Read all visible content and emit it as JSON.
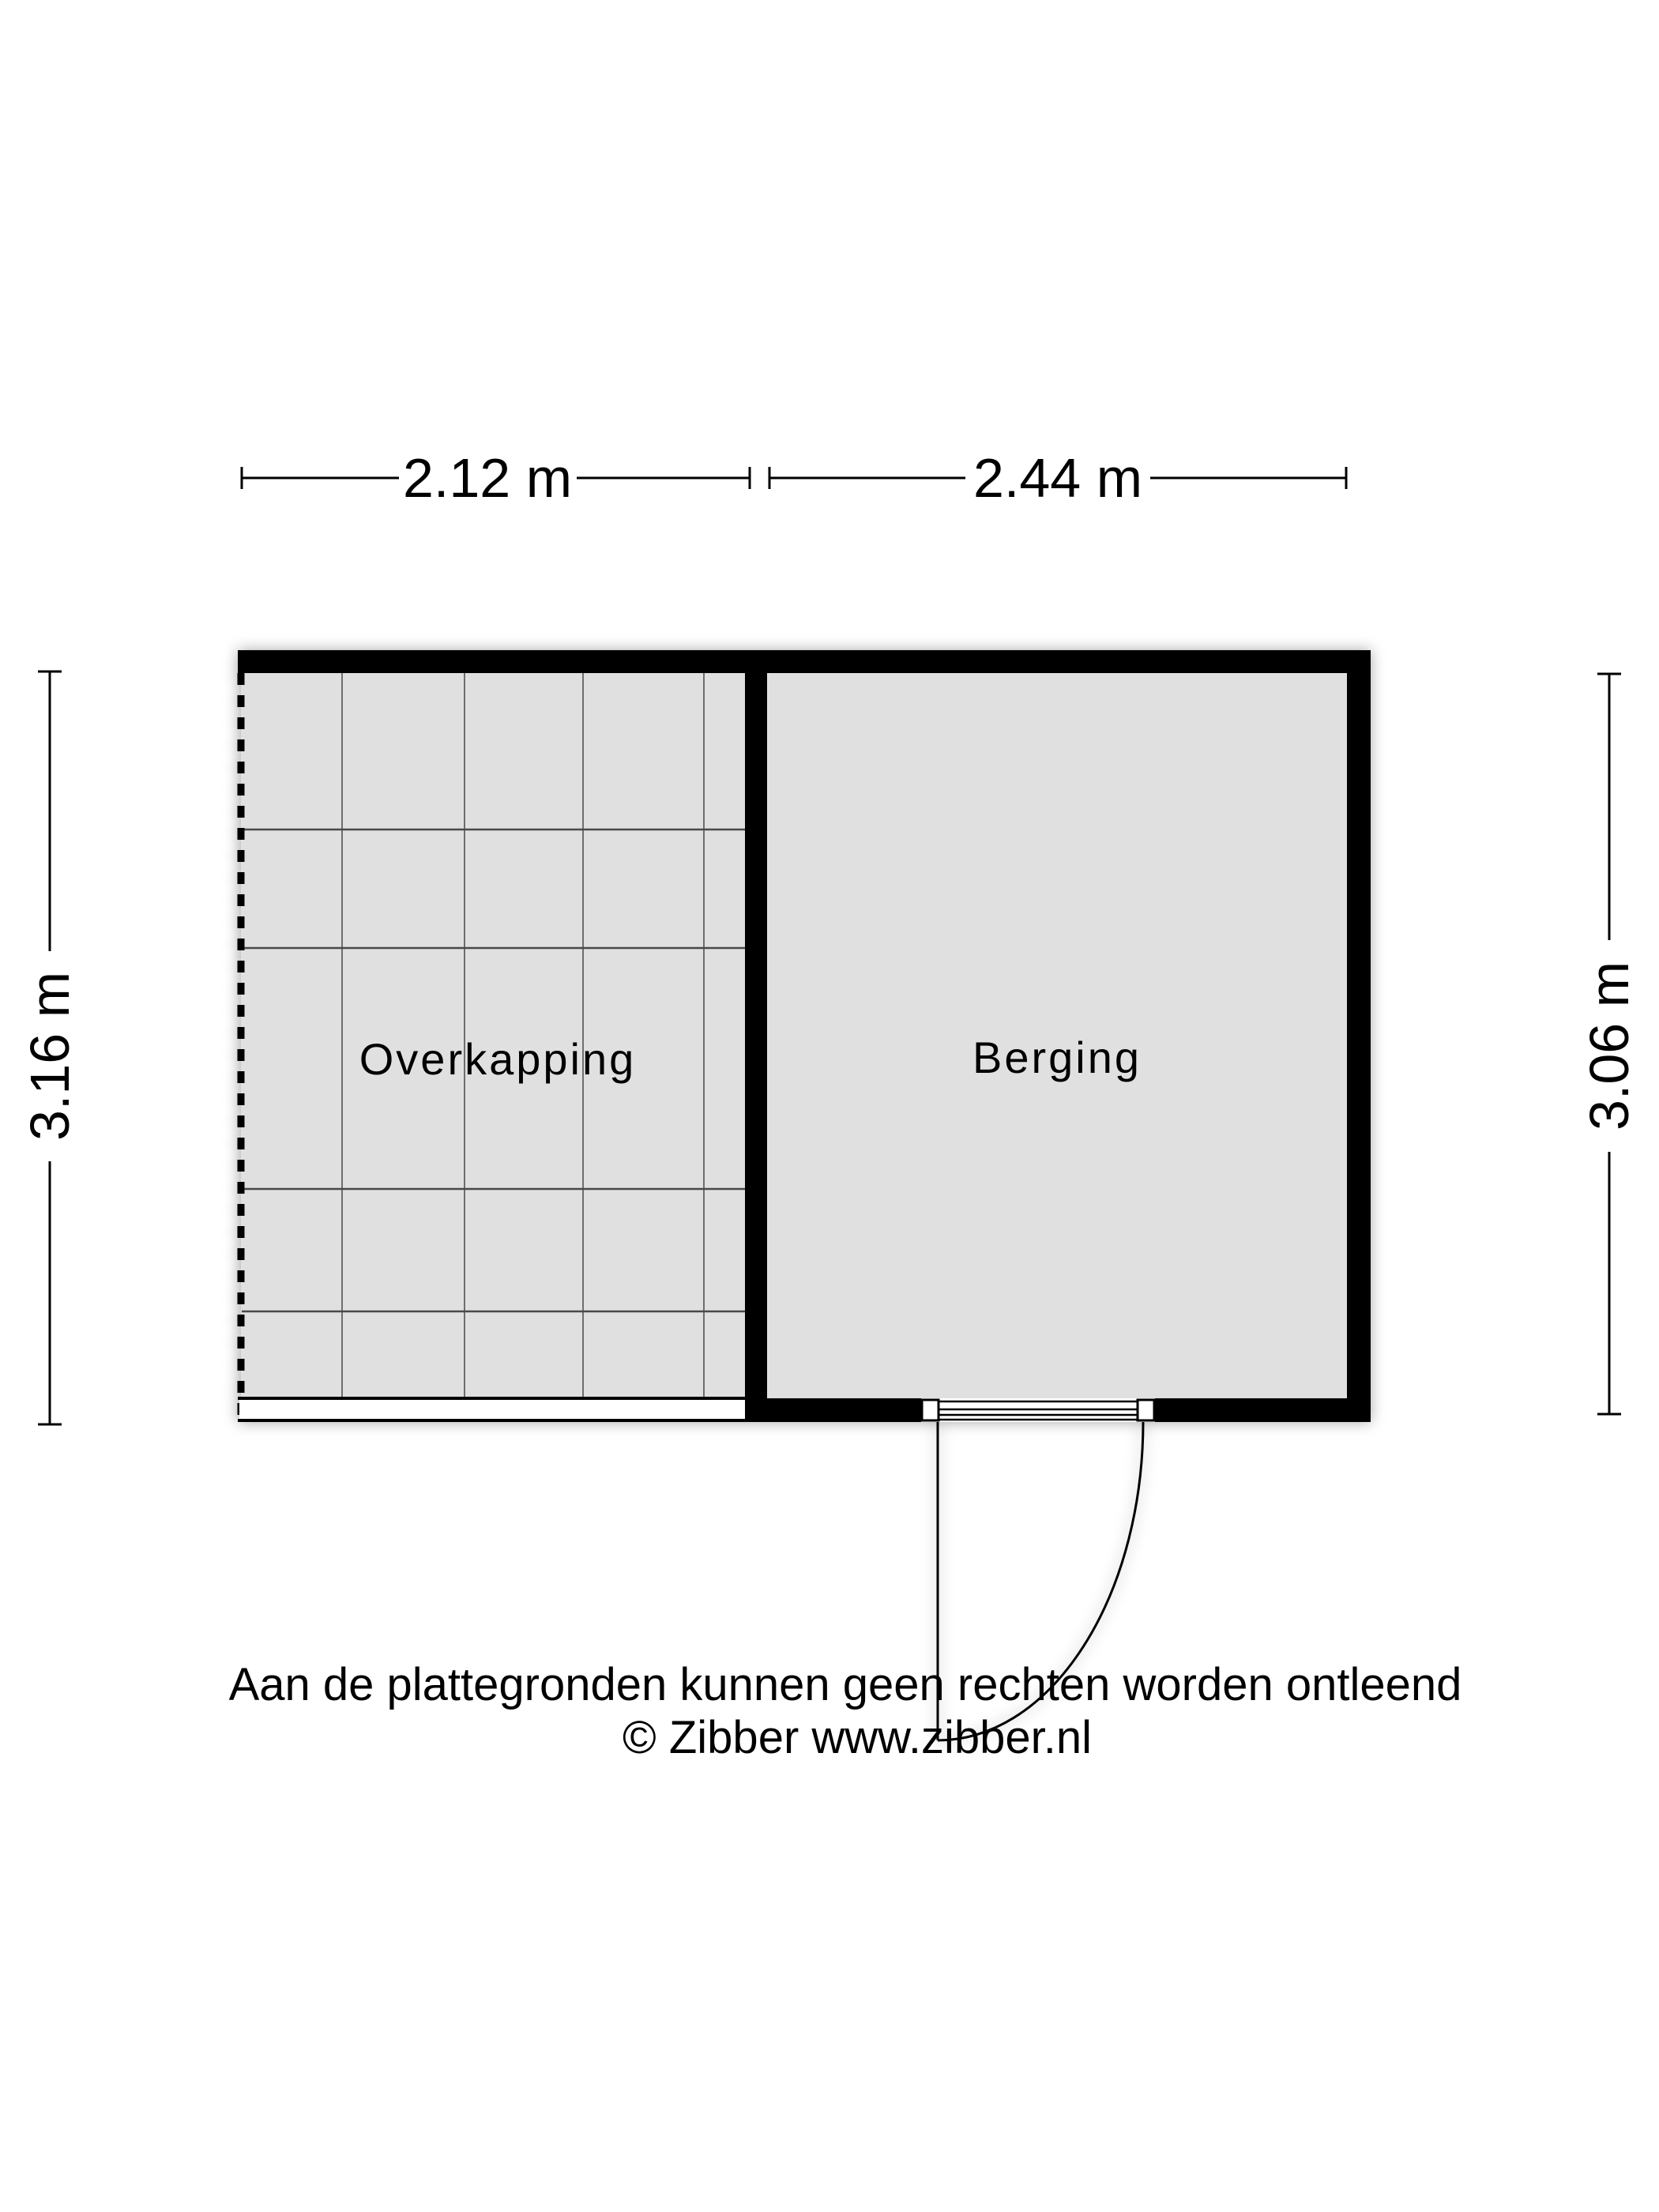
{
  "floorplan": {
    "rooms": [
      {
        "label": "Overkapping"
      },
      {
        "label": "Berging"
      }
    ],
    "dimensions": {
      "overkapping_width": "2.12 m",
      "berging_width": "2.44 m",
      "overkapping_height": "3.16 m",
      "berging_height": "3.06 m"
    },
    "footer": {
      "disclaimer": "Aan de plattegronden kunnen geen rechten worden ontleend",
      "copyright": "© Zibber www.zibber.nl"
    },
    "colors": {
      "wall": "#000000",
      "floor": "#e0e0e0",
      "grid": "#6e6e6e",
      "background": "#ffffff"
    }
  }
}
